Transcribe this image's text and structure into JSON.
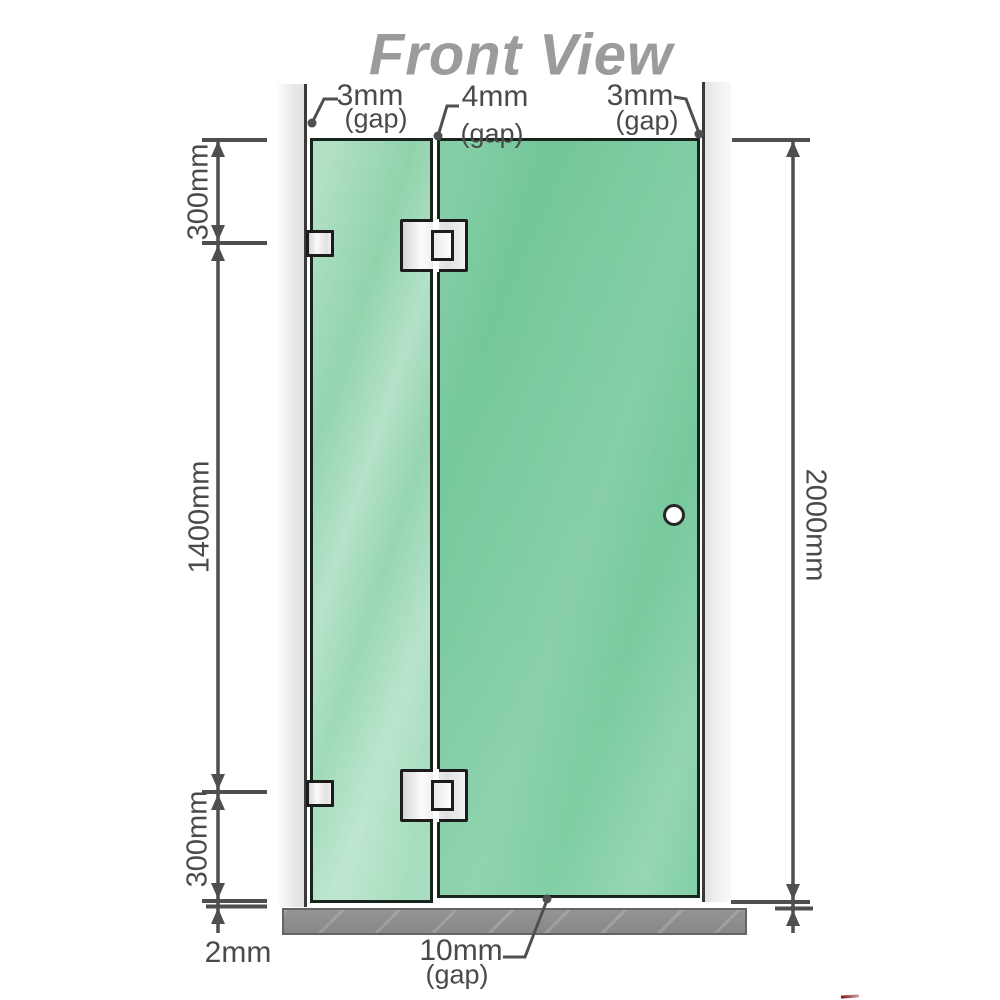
{
  "title": "Front View",
  "gap_labels": {
    "left": {
      "value": "3mm",
      "suffix": "(gap)"
    },
    "middle": {
      "value": "4mm",
      "suffix": "(gap)"
    },
    "right": {
      "value": "3mm",
      "suffix": "(gap)"
    },
    "bottom": {
      "value": "10mm",
      "suffix": "(gap)"
    }
  },
  "dimension_labels": {
    "left_top": "300mm",
    "left_middle": "1400mm",
    "left_bottom": "300mm",
    "bottom_left": "2mm",
    "right": "2000mm"
  },
  "colors": {
    "glass_fixed_panel": "#93d4af",
    "glass_door_panel": "#74c79b",
    "wall": "#e9e9e9",
    "wall_edge": "#3a3a3a",
    "floor_base": "#8d8d8d",
    "hardware_fill": "#eeeeee",
    "hardware_border": "#1c1c1c",
    "dimension_lines": "#4f4f4f",
    "label_text": "#4a4a4a",
    "title_text": "#9b9b9b"
  }
}
